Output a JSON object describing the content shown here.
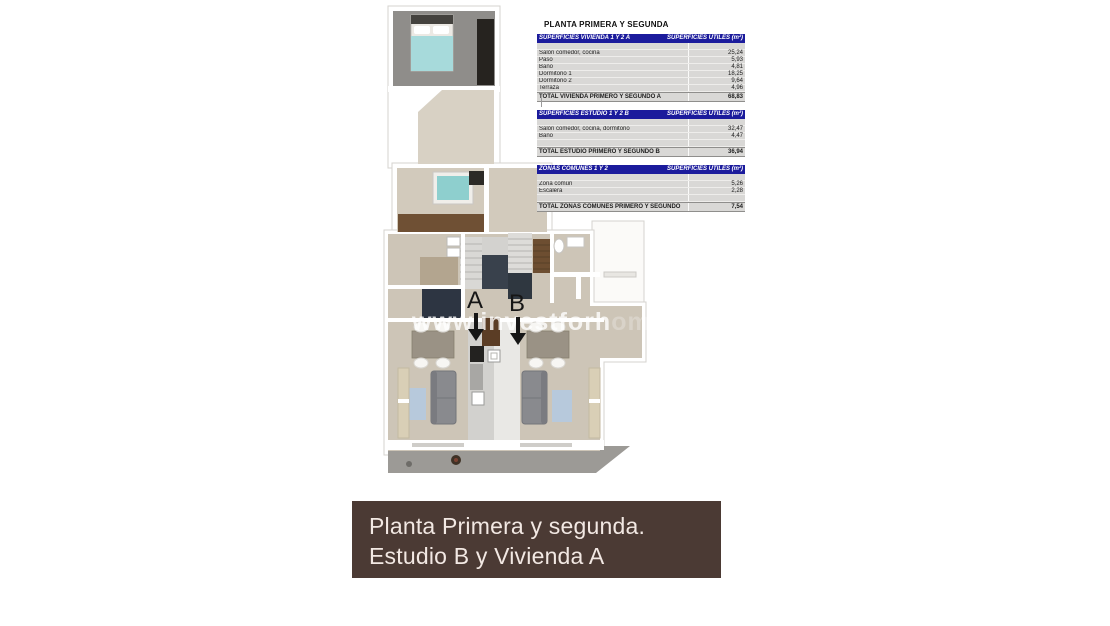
{
  "title": "PLANTA PRIMERA Y SEGUNDA",
  "tables": [
    {
      "header_left": "SUPERFICIES VIVIENDA 1 Y 2 A",
      "header_right": "SUPERFICIES UTILES  (m²)",
      "rows": [
        {
          "label": "",
          "value": ""
        },
        {
          "label": "Salón comedor, cocina",
          "value": "25,24"
        },
        {
          "label": "Paso",
          "value": "5,93"
        },
        {
          "label": "Baño",
          "value": "4,81"
        },
        {
          "label": "Dormitorio 1",
          "value": "18,25"
        },
        {
          "label": "Dormitorio 2",
          "value": "9,64"
        },
        {
          "label": "Terraza",
          "value": "4,96"
        }
      ],
      "total": {
        "label": "TOTAL VIVIENDA PRIMERO Y SEGUNDO A",
        "value": "68,83"
      }
    },
    {
      "header_left": "SUPERFICIES ESTUDIO 1 Y 2 B",
      "header_right": "SUPERFICIES UTILES  (m²)",
      "rows": [
        {
          "label": "",
          "value": ""
        },
        {
          "label": "Salón comedor, cocina, dormitorio",
          "value": "32,47"
        },
        {
          "label": "Baño",
          "value": "4,47"
        },
        {
          "label": "",
          "value": ""
        }
      ],
      "total": {
        "label": "TOTAL ESTUDIO PRIMERO Y SEGUNDO B",
        "value": "36,94"
      }
    },
    {
      "header_left": "ZONAS COMUNES 1 Y 2",
      "header_right": "SUPERFICIES UTILES  (m²)",
      "rows": [
        {
          "label": "",
          "value": ""
        },
        {
          "label": "Zona común",
          "value": "5,26"
        },
        {
          "label": "Escalera",
          "value": "2,28"
        },
        {
          "label": "",
          "value": ""
        }
      ],
      "total": {
        "label": "TOTAL ZONAS COMUNES PRIMERO Y SEGUNDO",
        "value": "7,54"
      }
    }
  ],
  "plan": {
    "watermark": {
      "text": "www.investforh",
      "faded": "om"
    },
    "unit_labels": {
      "a": "A",
      "b": "B"
    }
  },
  "caption": {
    "line1": "Planta Primera y segunda.",
    "line2": "Estudio B y Vivienda A"
  },
  "colors": {
    "table_header_blue": "#1b1b9c",
    "table_body_gray": "#d9d8d6",
    "caption_brown": "#4b3a34",
    "caption_text": "#f2e8e3",
    "floor_beige": "#cdc5b7",
    "bed_teal": "#a7dadb",
    "tub_teal": "#8ecfce",
    "stair_navy": "#39414c",
    "wood_brown": "#6f5034",
    "terrace_gray": "#9c9a96"
  }
}
